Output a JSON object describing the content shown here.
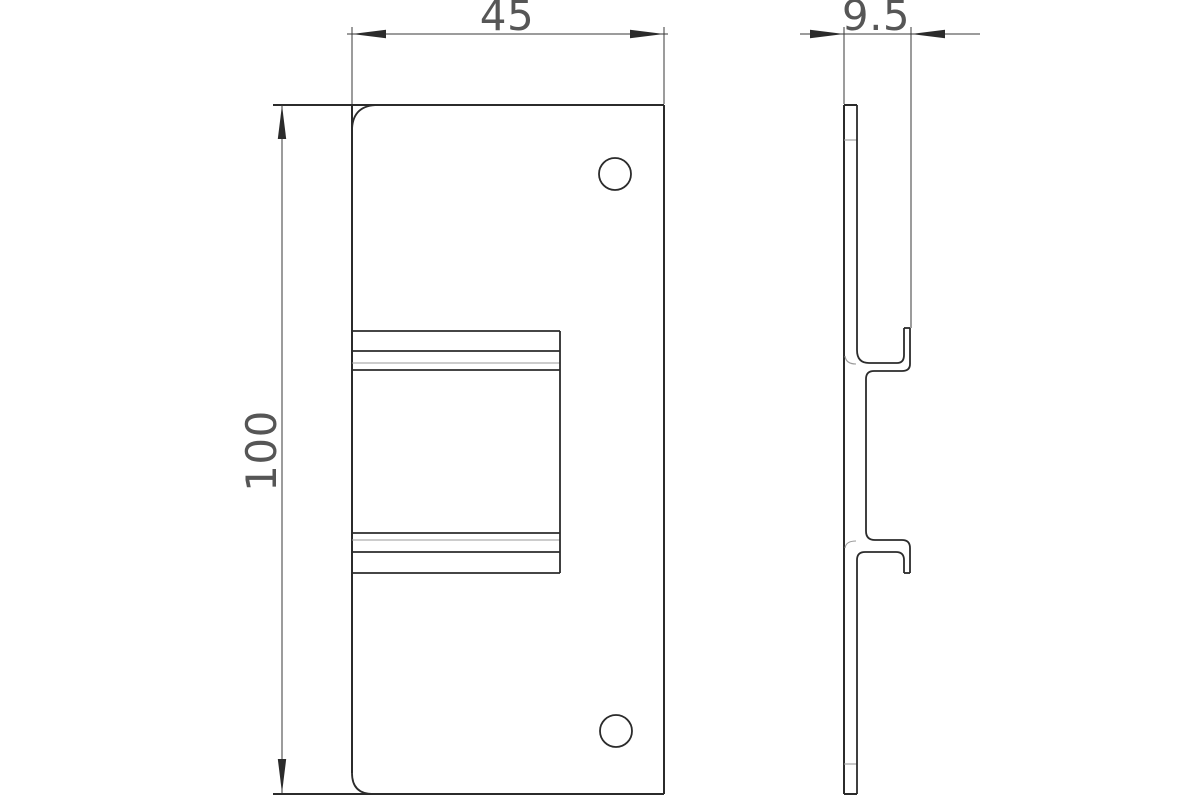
{
  "drawing": {
    "background_color": "#ffffff",
    "line_color": "#2b2b2b",
    "thin_line_color": "#9a9a9a",
    "dimension_text_color": "#565656",
    "dimensions": {
      "width_label": "45",
      "height_label": "100",
      "depth_label": "9.5"
    }
  }
}
